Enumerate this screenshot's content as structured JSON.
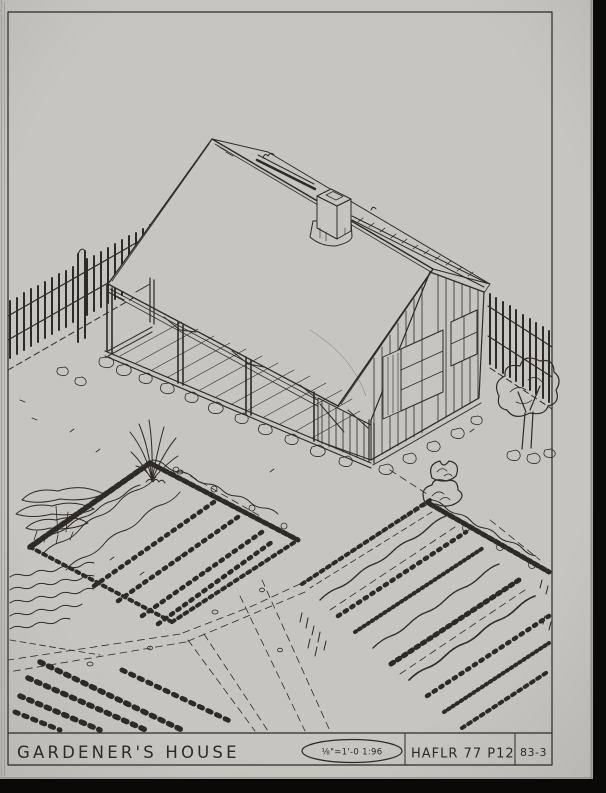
{
  "title_block": {
    "title": "GARDENER'S HOUSE",
    "scale_stamp": "⅛\"=1'-0  1:96",
    "reference": "HAFLR 77 P12",
    "sheet_number": "83-3"
  },
  "scene": {
    "subject": "isometric-pen-drawing-of-gardener's-house",
    "elements": [
      "house-with-open-porch",
      "chimney",
      "picket-fence",
      "garden-beds",
      "shrubs",
      "tree"
    ]
  },
  "colors": {
    "paper": "#c6c5c0",
    "ink": "#2e2a24",
    "scan_background": "#0a0908"
  }
}
